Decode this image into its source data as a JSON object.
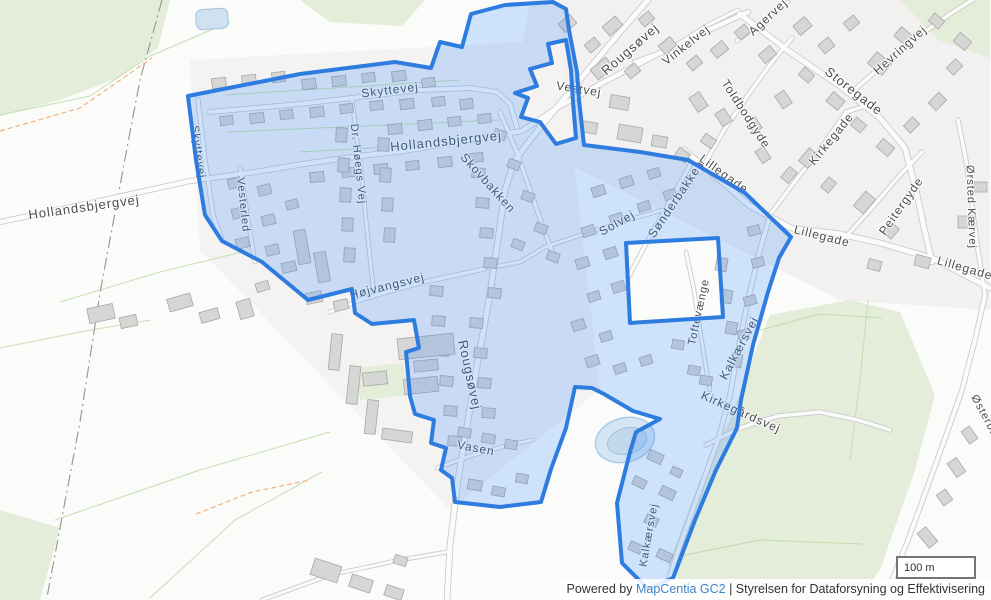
{
  "map": {
    "labels": [
      {
        "text": "Skyttevej",
        "x": 390,
        "y": 90,
        "r": -7,
        "s": 12
      },
      {
        "text": "Skyttevej",
        "x": 198,
        "y": 152,
        "r": 82,
        "s": 11
      },
      {
        "text": "Hollandsbjergvej",
        "x": 446,
        "y": 141,
        "r": -6,
        "s": 13
      },
      {
        "text": "Hollandsbjergvej",
        "x": 84,
        "y": 207,
        "r": -8,
        "s": 13
      },
      {
        "text": "Dr. Høegs Vej",
        "x": 358,
        "y": 164,
        "r": 84,
        "s": 11
      },
      {
        "text": "Vesterled",
        "x": 243,
        "y": 205,
        "r": 84,
        "s": 11
      },
      {
        "text": "Skovbakken",
        "x": 488,
        "y": 183,
        "r": 48,
        "s": 12
      },
      {
        "text": "Rougsøvej",
        "x": 630,
        "y": 49,
        "r": -41,
        "s": 13
      },
      {
        "text": "Rougsøvej",
        "x": 470,
        "y": 375,
        "r": 78,
        "s": 13
      },
      {
        "text": "Vestvej",
        "x": 579,
        "y": 89,
        "r": 9,
        "s": 12
      },
      {
        "text": "Vinkelvej",
        "x": 686,
        "y": 45,
        "r": -38,
        "s": 12
      },
      {
        "text": "Agervej",
        "x": 768,
        "y": 17,
        "r": -43,
        "s": 12
      },
      {
        "text": "Hevringvej",
        "x": 900,
        "y": 50,
        "r": -42,
        "s": 12
      },
      {
        "text": "Storegade",
        "x": 854,
        "y": 91,
        "r": 38,
        "s": 13
      },
      {
        "text": "Toldbodgyde",
        "x": 746,
        "y": 114,
        "r": 57,
        "s": 12
      },
      {
        "text": "Kirkegade",
        "x": 831,
        "y": 139,
        "r": -51,
        "s": 12
      },
      {
        "text": "Lillegade",
        "x": 724,
        "y": 174,
        "r": 36,
        "s": 12
      },
      {
        "text": "Lillegade",
        "x": 822,
        "y": 236,
        "r": 14,
        "s": 12
      },
      {
        "text": "Lillegade",
        "x": 965,
        "y": 268,
        "r": 16,
        "s": 12
      },
      {
        "text": "Peitergyde",
        "x": 901,
        "y": 206,
        "r": -55,
        "s": 12
      },
      {
        "text": "Ørsted Kærvej",
        "x": 971,
        "y": 207,
        "r": 88,
        "s": 11
      },
      {
        "text": "Solvej",
        "x": 617,
        "y": 223,
        "r": -29,
        "s": 12
      },
      {
        "text": "Sønderbakken",
        "x": 676,
        "y": 199,
        "r": -56,
        "s": 12
      },
      {
        "text": "Toftevænge",
        "x": 699,
        "y": 312,
        "r": -78,
        "s": 11
      },
      {
        "text": "Kalkærsvej",
        "x": 739,
        "y": 348,
        "r": -62,
        "s": 12
      },
      {
        "text": "Kirkegårdsvej",
        "x": 741,
        "y": 412,
        "r": 24,
        "s": 12
      },
      {
        "text": "Kalkærsvej",
        "x": 649,
        "y": 535,
        "r": -80,
        "s": 11
      },
      {
        "text": "Højvangsvej",
        "x": 387,
        "y": 286,
        "r": -14,
        "s": 12
      },
      {
        "text": "Vasen",
        "x": 476,
        "y": 448,
        "r": 11,
        "s": 12
      },
      {
        "text": "Østerbakken",
        "x": 991,
        "y": 428,
        "r": 62,
        "s": 11
      }
    ]
  },
  "controls": {
    "scale": {
      "label": "100 m"
    }
  },
  "attribution": {
    "prefix": "Powered by ",
    "link_label": "MapCentia GC2",
    "suffix": " | Styrelsen for Dataforsyning og Effektivisering"
  },
  "colors": {
    "selection_stroke": "#2e7ce0",
    "selection_fill": "rgba(51,136,255,0.22)",
    "link": "#3d85c8",
    "label_text": "#4c4c4c",
    "road_fill": "#fbfbfa",
    "road_casing": "#c9c9c7",
    "building_fill": "#d6d6d4",
    "vegetation": "#e4ecda",
    "water": "#cfe2f1"
  }
}
